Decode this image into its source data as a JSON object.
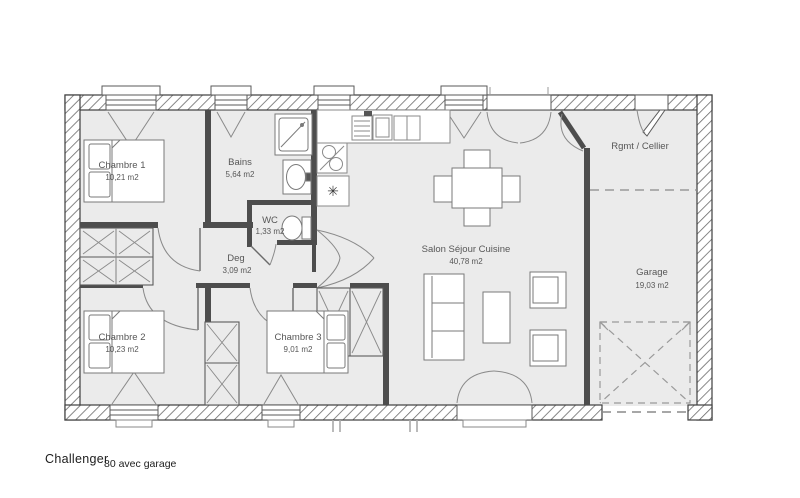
{
  "plan": {
    "title": "Challenger",
    "subtitle": "80 avec garage",
    "rooms": {
      "chambre1": {
        "name": "Chambre 1",
        "area": "10,21 m2"
      },
      "bains": {
        "name": "Bains",
        "area": "5,64 m2"
      },
      "wc": {
        "name": "WC",
        "area": "1,33 m2"
      },
      "deg": {
        "name": "Deg",
        "area": "3,09 m2"
      },
      "chambre2": {
        "name": "Chambre 2",
        "area": "10,23 m2"
      },
      "chambre3": {
        "name": "Chambre 3",
        "area": "9,01 m2"
      },
      "salon": {
        "name": "Salon Séjour Cuisine",
        "area": "40,78 m2"
      },
      "cellier": {
        "name": "Rgmt / Cellier"
      },
      "garage": {
        "name": "Garage",
        "area": "19,03 m2"
      }
    },
    "kitchen": {
      "star_symbol": "✳"
    },
    "colors": {
      "wall": "#3e3e3e",
      "hatch": "#6a6a6a",
      "floor": "#ebebeb",
      "furniture_line": "#7a7a7a",
      "label_text": "#575757"
    }
  }
}
